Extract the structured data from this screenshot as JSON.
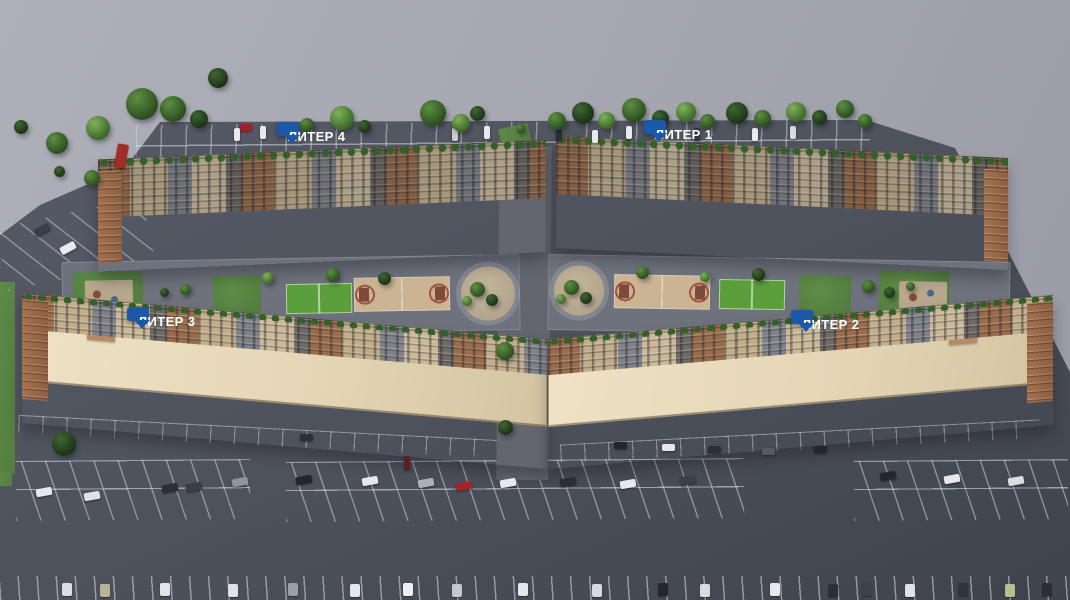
{
  "buildings": [
    {
      "id": "liter-4",
      "label": "ЛИТЕР 4"
    },
    {
      "id": "liter-1",
      "label": "ЛИТЕР 1"
    },
    {
      "id": "liter-3",
      "label": "ЛИТЕР 3"
    },
    {
      "id": "liter-2",
      "label": "ЛИТЕР 2"
    }
  ],
  "colors": {
    "tag_bg": "#1b58a7",
    "tag_text": "#ffffff",
    "background": "#a6a7b1",
    "asphalt": "#4e525c",
    "roof": "#e3d5b4",
    "grass": "#547e40",
    "court_green": "#5b9e3c",
    "court_sand": "#cbb493"
  }
}
